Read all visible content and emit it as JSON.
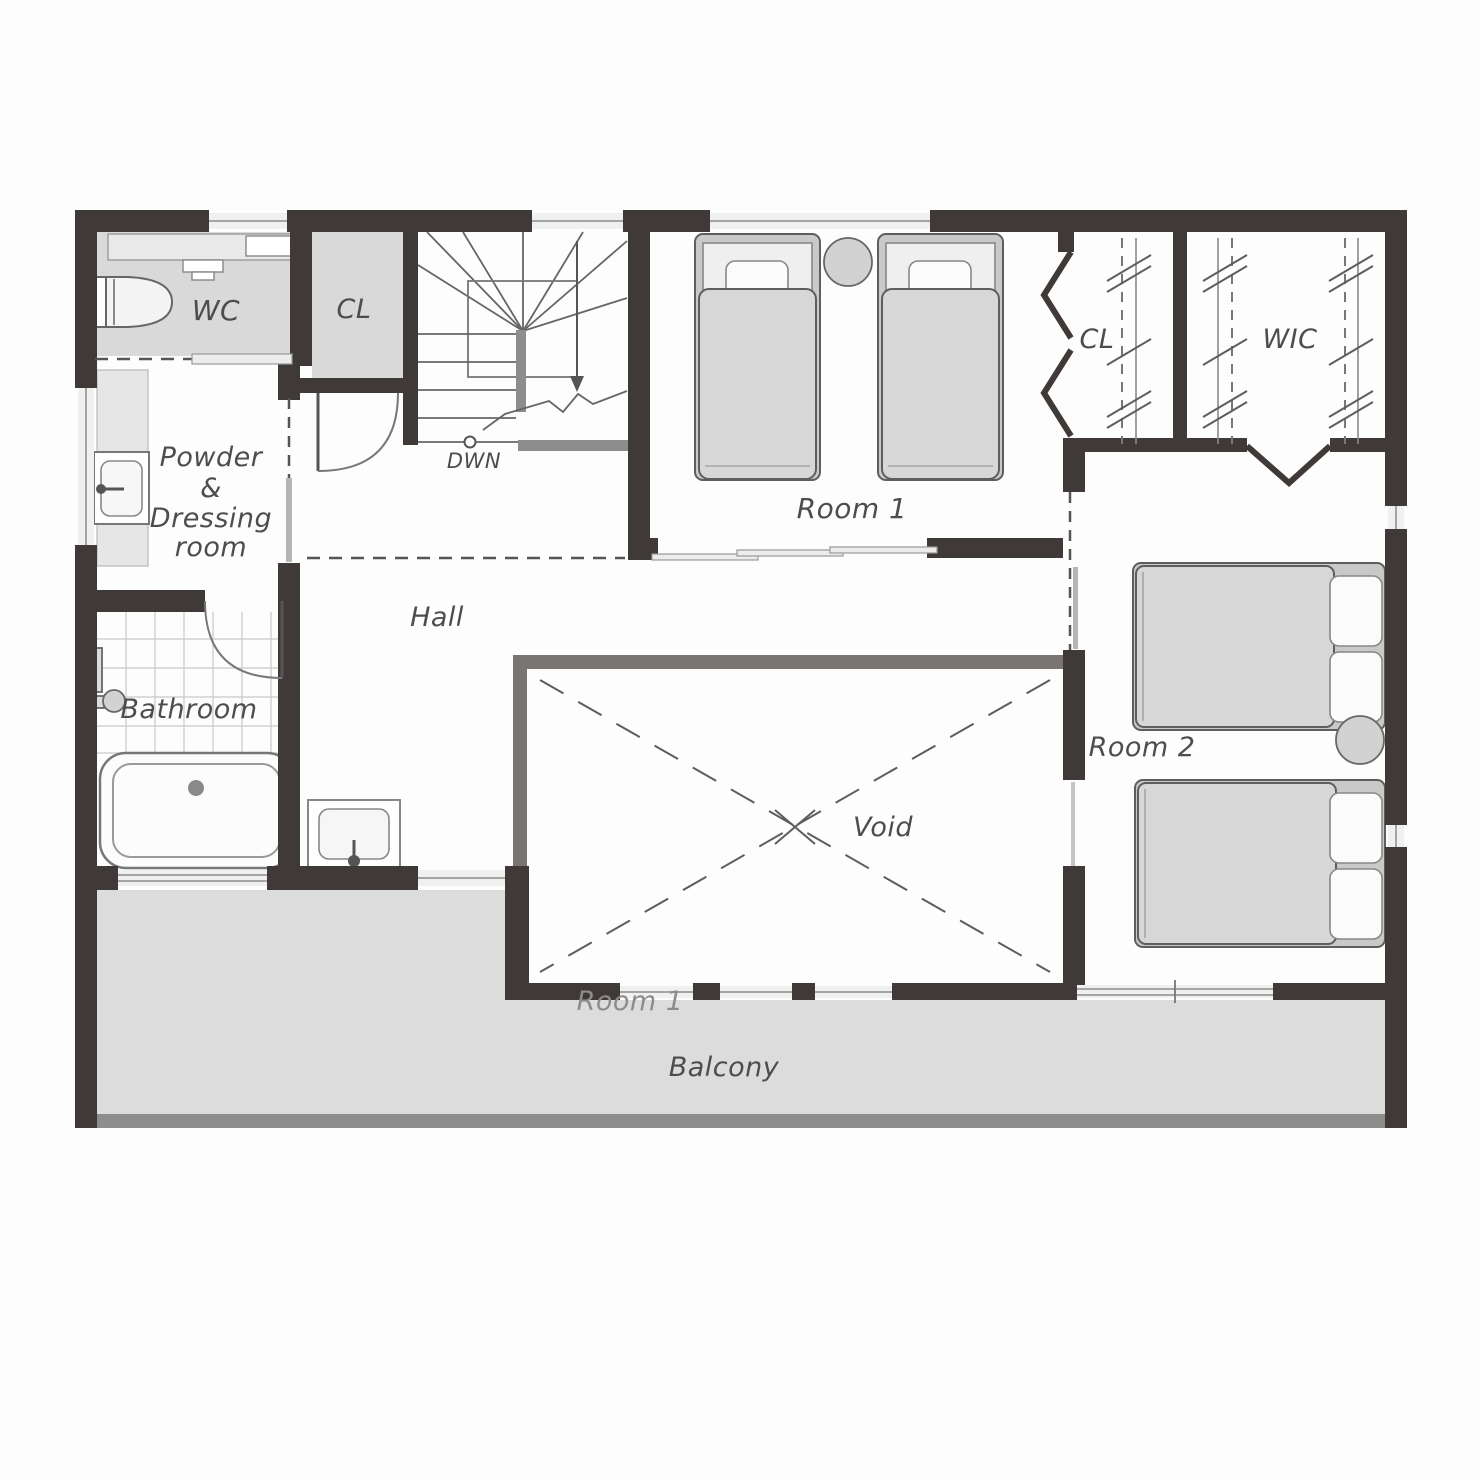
{
  "plan": {
    "type": "residential-floor-plan",
    "floor": "second-floor",
    "labels": {
      "wc": "WC",
      "closet_top": "CL",
      "stairs_down": "DWN",
      "room1": "Room 1",
      "closet_right": "CL",
      "wic": "WIC",
      "powder_line1": "Powder",
      "powder_line2": "&",
      "powder_line3": "Dressing",
      "powder_line4": "room",
      "hall": "Hall",
      "bathroom": "Bathroom",
      "void": "Void",
      "room2": "Room 2",
      "room1_below_void": "Room 1",
      "balcony": "Balcony"
    },
    "colors": {
      "wall": "#3f3a37",
      "room_fill": "#d9d9d9",
      "balcony_fill": "#dcdcdc",
      "void_wall": "#787572",
      "half_wall": "#8d8d8d",
      "text": "#4d4d4d",
      "text_muted": "#8f8b88",
      "background": "#fdfdfd"
    }
  }
}
